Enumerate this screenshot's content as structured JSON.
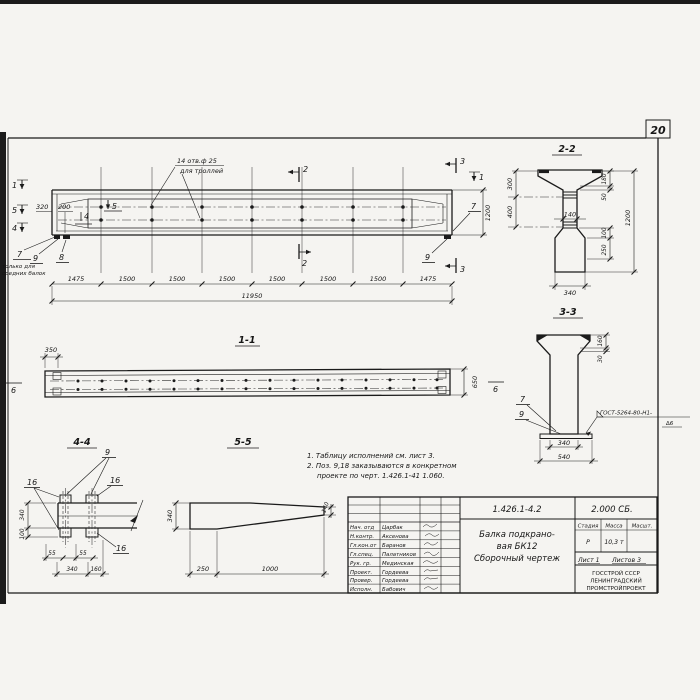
{
  "page_number": "20",
  "colors": {
    "line": "#1b1b1b",
    "paper": "#f5f4f1"
  },
  "main_view": {
    "hole_note": [
      "14 отв.ф 25",
      "для троллей"
    ],
    "left_markers": [
      "1",
      "5",
      "4"
    ],
    "inner_marker_5": "5",
    "inner_marker_4": "4",
    "cut_top_2": "2",
    "cut_bottom_2": "2",
    "cut_top_3": "3",
    "cut_bottom_3": "3",
    "cut_right_1": "1",
    "callout_7": "7",
    "callout_8": "8",
    "callout_9": "9",
    "callout_7_right": "7",
    "callout_9_right": "9",
    "note7": [
      "только для",
      "средних балок"
    ],
    "dim_320": "320",
    "dim_200": "200",
    "dim_1200": "1200",
    "segments": [
      "1475",
      "1500",
      "1500",
      "1500",
      "1500",
      "1500",
      "1500",
      "1475"
    ],
    "total": "11950"
  },
  "section_1_1": {
    "title": "1-1",
    "dim_350": "350",
    "dim_650": "650",
    "marker_left": "6",
    "marker_right": "6"
  },
  "section_2_2": {
    "title": "2-2",
    "dim_300": "300",
    "dim_400": "400",
    "dim_140": "140",
    "dim_180": "180",
    "dim_50": "50",
    "dim_1200": "1200",
    "dim_100": "100",
    "dim_250": "250",
    "dim_340": "340"
  },
  "section_3_3": {
    "title": "3-3",
    "dim_160": "160",
    "dim_30": "30",
    "dim_340": "340",
    "dim_540": "540",
    "callout_7": "7",
    "callout_9": "9",
    "weld_note": "ГОСТ-5264-80-Н1-",
    "weld_size": "∆6"
  },
  "view_4_4": {
    "title": "4-4",
    "callout_9": "9",
    "callout_16a": "16",
    "callout_16b": "16",
    "callout_16c": "16",
    "dim_340v": "340",
    "dim_100": "100",
    "dim_55a": "55",
    "dim_55b": "55",
    "dim_340": "340",
    "dim_160": "160"
  },
  "view_5_5": {
    "title": "5-5",
    "dim_340": "340",
    "dim_140": "140",
    "dim_250": "250",
    "dim_1000": "1000"
  },
  "notes": [
    "1. Таблицу исполнений см. лист 3.",
    "2. Поз. 9,18 заказываются в конкретном",
    "проекте по черт. 1.426.1-41 1.060."
  ],
  "title_block": {
    "doc_number": "1.426.1-4.2",
    "doc_code": "2.000 СБ.",
    "title_lines": [
      "Балка подкрано-",
      "вая БК12",
      "Сборочный чертеж"
    ],
    "headers": {
      "stage": "Стадия",
      "mass": "Масса",
      "scale": "Масшт."
    },
    "values": {
      "stage": "Р",
      "mass": "10,3 т"
    },
    "sheet": "Лист 1",
    "sheets": "Листов 3",
    "org": [
      "ГОССТРОЙ СССР",
      "ЛЕНИНГРАДСКИЙ",
      "ПРОМСТРОЙПРОЕКТ"
    ],
    "roles": [
      {
        "role": "Нач. отд",
        "name": "Царбак"
      },
      {
        "role": "Н.контр.",
        "name": "Аксенова"
      },
      {
        "role": "Гл.кон.от",
        "name": "Баранов"
      },
      {
        "role": "Гл.спец.",
        "name": "Палатников"
      },
      {
        "role": "Рук. гр.",
        "name": "Мединская"
      },
      {
        "role": "Проект.",
        "name": "Гордеева"
      },
      {
        "role": "Провер.",
        "name": "Гордеева"
      },
      {
        "role": "Исполн.",
        "name": "Бабович"
      }
    ]
  }
}
